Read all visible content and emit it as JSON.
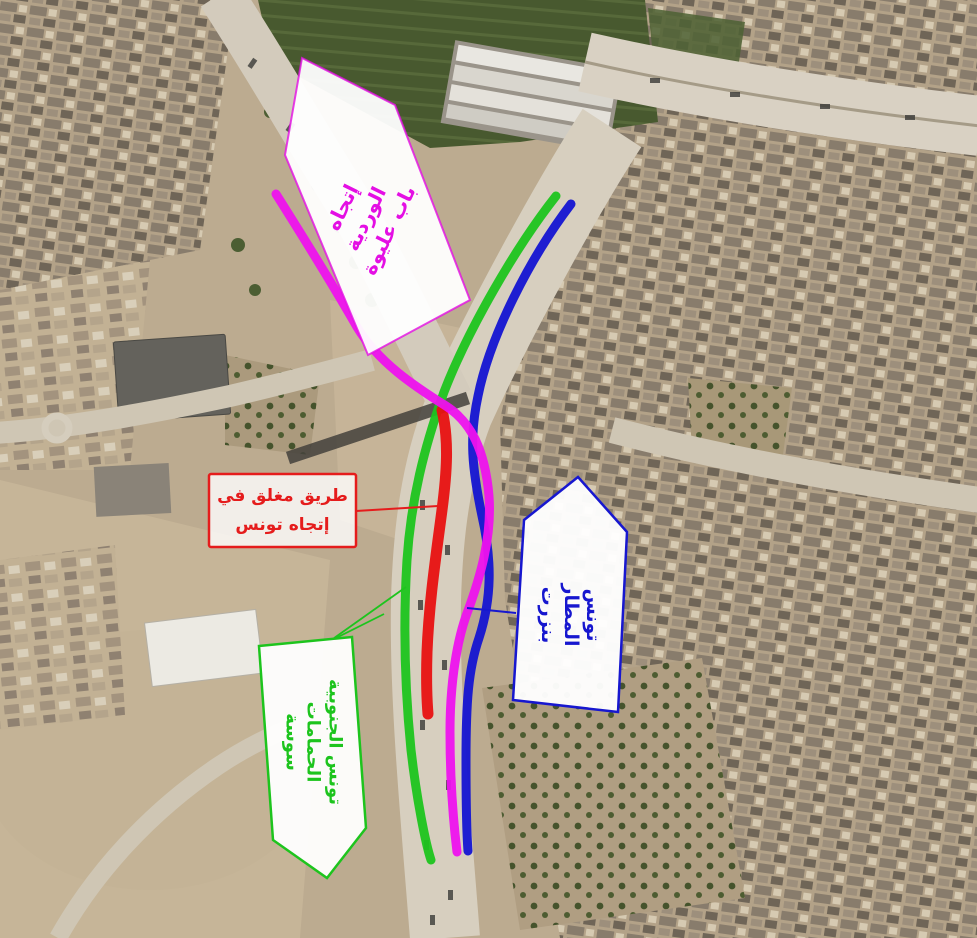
{
  "callouts": {
    "deviation_direction": {
      "lines": [
        "إتجاه",
        "الوردية",
        "باب عليوة"
      ],
      "color": "#e40fe4"
    },
    "road_closed": {
      "lines": [
        "طريق مغلق في",
        "إتجاه تونس"
      ],
      "color": "#e51c1c"
    },
    "northbound_destinations": {
      "lines": [
        "تونس",
        "المطار",
        "بنزرت"
      ],
      "color": "#1717cf"
    },
    "southbound_destinations": {
      "lines": [
        "تونس الجنوبية",
        "الحمامات",
        "سوسة"
      ],
      "color": "#1dc41d"
    }
  },
  "routes": {
    "deviation": {
      "color": "#ee12ee"
    },
    "closed": {
      "color": "#e81111"
    },
    "northbound": {
      "color": "#1414d2"
    },
    "southbound": {
      "color": "#1dc41d"
    }
  }
}
